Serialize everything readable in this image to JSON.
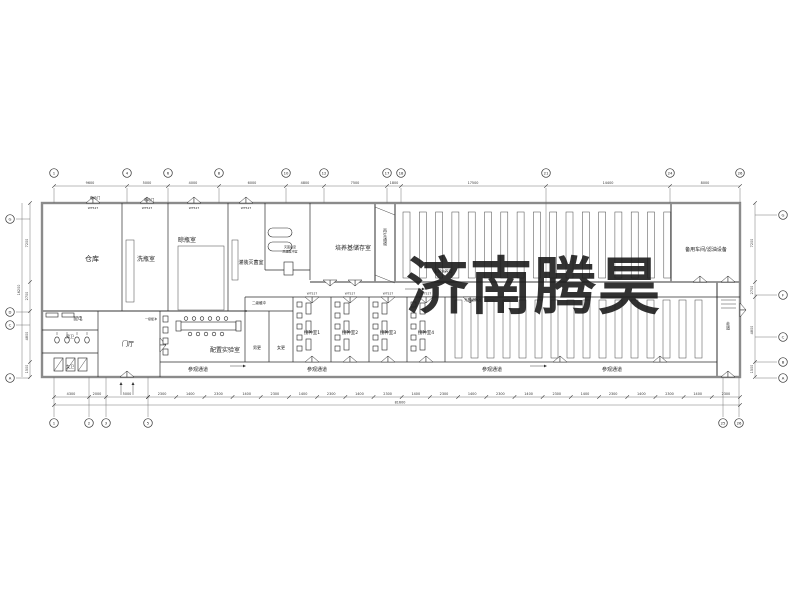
{
  "watermark": {
    "text": "济南腾昊",
    "color": "#e23539"
  },
  "rooms": {
    "warehouse": "仓库",
    "bottle_wash": "洗瓶室",
    "bottle_dry": "晾瓶室",
    "filling_steril": "灌装灭菌室",
    "post_steril_line1": "灭菌后室",
    "post_steril_line2": "高温缓冲室",
    "medium_storage": "培养基储存室",
    "regen_corridor": "再生通道",
    "light_culture": "光照培养室",
    "spare_workshop": "备用车间/滤油设备",
    "power": "配电",
    "male_wc": "男卫",
    "female_wc": "女卫",
    "lobby": "门厅",
    "buffer1": "一级缓冲",
    "buffer2": "二级缓冲",
    "male_change": "男更",
    "female_change": "女更",
    "prep_lab": "配置实验室",
    "inoc1": "接种室1",
    "inoc2": "接种室2",
    "inoc3": "接种室3",
    "inoc4": "接种室4",
    "visit_corridor": "参观通道",
    "right_corridor": "走道",
    "electric_door": "电动门",
    "door_tag": "WT527"
  },
  "grid": {
    "top": [
      {
        "x": 54,
        "n": "1"
      },
      {
        "x": 127,
        "n": "4"
      },
      {
        "x": 168,
        "n": "6"
      },
      {
        "x": 219,
        "n": "8"
      },
      {
        "x": 286,
        "n": "10"
      },
      {
        "x": 324,
        "n": "12"
      },
      {
        "x": 387,
        "n": "17"
      },
      {
        "x": 401,
        "n": "18"
      },
      {
        "x": 546,
        "n": "21"
      },
      {
        "x": 670,
        "n": "24"
      },
      {
        "x": 740,
        "n": "26"
      }
    ],
    "bottom": [
      {
        "x": 54,
        "n": "1"
      },
      {
        "x": 89,
        "n": "2"
      },
      {
        "x": 106,
        "n": "3"
      },
      {
        "x": 148,
        "n": "5"
      },
      {
        "x": 723,
        "n": "25"
      },
      {
        "x": 739,
        "n": "26"
      }
    ],
    "left": [
      {
        "y": 219,
        "n": "G"
      },
      {
        "y": 312,
        "n": "D"
      },
      {
        "y": 325,
        "n": "C"
      },
      {
        "y": 378,
        "n": "A"
      }
    ],
    "right": [
      {
        "y": 215,
        "n": "G"
      },
      {
        "y": 295,
        "n": "F"
      },
      {
        "y": 337,
        "n": "C"
      },
      {
        "y": 362,
        "n": "B"
      },
      {
        "y": 378,
        "n": "A"
      }
    ]
  },
  "dimensions": {
    "top": [
      {
        "x": 90,
        "v": "9600"
      },
      {
        "x": 147,
        "v": "5000"
      },
      {
        "x": 193,
        "v": "4000"
      },
      {
        "x": 252,
        "v": "6000"
      },
      {
        "x": 305,
        "v": "4800"
      },
      {
        "x": 355,
        "v": "7500"
      },
      {
        "x": 394,
        "v": "1800"
      },
      {
        "x": 473,
        "v": "17500"
      },
      {
        "x": 608,
        "v": "14400"
      },
      {
        "x": 705,
        "v": "8000"
      }
    ],
    "bottom_left": [
      {
        "x": 71,
        "v": "4300"
      },
      {
        "x": 97,
        "v": "2000"
      },
      {
        "x": 127,
        "v": "5000"
      }
    ],
    "bottom_series": [
      "2300",
      "1400",
      "2300",
      "1400",
      "2300",
      "1400",
      "2300",
      "1400",
      "2300",
      "1400",
      "2300",
      "1400",
      "2300",
      "1400",
      "2300",
      "1400",
      "2300",
      "1400",
      "2300",
      "1400",
      "2300"
    ],
    "bottom_total": "81600",
    "left": [
      {
        "y": 243,
        "v": "7200"
      },
      {
        "y": 296,
        "v": "2700"
      },
      {
        "y": 336,
        "v": "4800"
      },
      {
        "y": 369,
        "v": "1500"
      }
    ],
    "left_total": "16200",
    "right": [
      {
        "y": 243,
        "v": "7200"
      },
      {
        "y": 290,
        "v": "2700"
      },
      {
        "y": 330,
        "v": "4800"
      },
      {
        "y": 369,
        "v": "1500"
      }
    ]
  }
}
